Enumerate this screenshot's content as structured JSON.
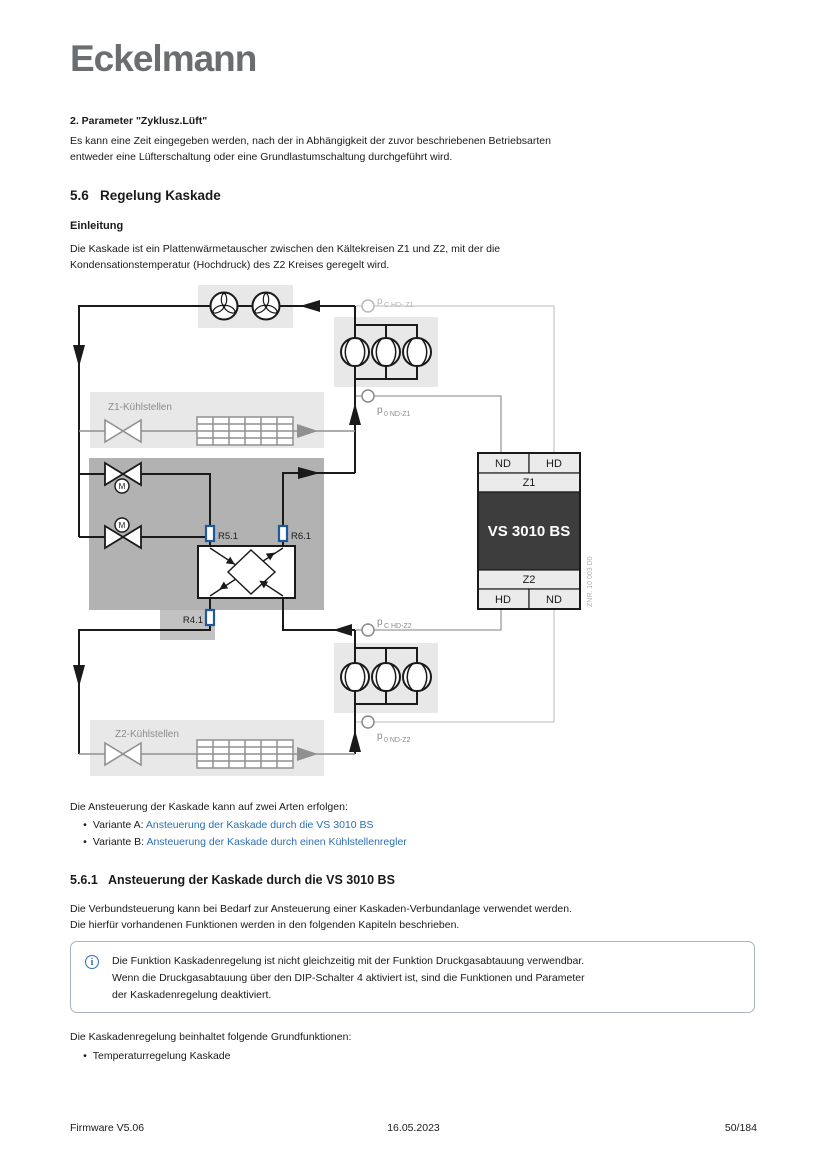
{
  "logo": {
    "text": "Eckelmann",
    "color": "#6b6e70"
  },
  "intro_block": {
    "heading": "2. Parameter \"Zyklusz.Lüft\"",
    "lines": [
      "Es kann eine Zeit eingegeben werden, nach der in Abhängigkeit der zuvor beschriebenen Betriebsarten",
      "entweder eine Lüfterschaltung oder eine Grundlastumschaltung durchgeführt wird."
    ]
  },
  "section_56": {
    "number": "5.6",
    "title": "Regelung Kaskade"
  },
  "einleitung": {
    "heading": "Einleitung",
    "lines": [
      "Die Kaskade ist ein Plattenwärmetauscher zwischen den Kältekreisen Z1 und Z2, mit der die",
      "Kondensationstemperatur (Hochdruck) des Z2 Kreises geregelt wird."
    ]
  },
  "diagram": {
    "z1_kuehlstellen": "Z1-Kühlstellen",
    "z2_kuehlstellen": "Z2-Kühlstellen",
    "r51": "R5.1",
    "r61": "R6.1",
    "r41": "R4.1",
    "motor_letter": "M",
    "controller": {
      "top_left": "ND",
      "top_right": "HD",
      "zone_top": "Z1",
      "name": "VS 3010 BS",
      "zone_bottom": "Z2",
      "bottom_left": "HD",
      "bottom_right": "ND",
      "znr": "ZNR. 10 003 D0"
    },
    "pressure_labels": {
      "symbol": "p",
      "hd_z1": "C HD- Z1",
      "nd_z1": "0 ND-Z1",
      "hd_z2": "C HD-Z2",
      "nd_z2": "0 ND-Z2"
    },
    "colors": {
      "light_box": "#e8e8e8",
      "dark_box": "#b2b2b2",
      "controller_dark": "#3d3d3d",
      "sensor_blue": "#1b5a9e",
      "gray_symbol": "#909090",
      "pipe_black": "#1a1a1a"
    }
  },
  "variants": {
    "intro": "Die Ansteuerung der Kaskade kann auf zwei Arten erfolgen:",
    "items": [
      {
        "bullet": "•",
        "prefix": "Variante A: ",
        "link": "Ansteuerung der Kaskade durch die VS 3010 BS"
      },
      {
        "bullet": "•",
        "prefix": "Variante B: ",
        "link": "Ansteuerung der Kaskade durch einen Kühlstellenregler"
      }
    ],
    "link_color": "#2b6fb5"
  },
  "section_561": {
    "number": "5.6.1",
    "title": "Ansteuerung der Kaskade durch die VS 3010 BS",
    "lines": [
      "Die Verbundsteuerung kann bei Bedarf zur Ansteuerung einer Kaskaden-Verbundanlage verwendet werden.",
      "Die hierfür vorhandenen Funktionen werden in den folgenden Kapiteln beschrieben."
    ]
  },
  "info_box": {
    "icon": "i",
    "lines": [
      "Die Funktion Kaskadenregelung ist nicht gleichzeitig mit der Funktion Druckgasabtauung verwendbar.",
      "Wenn die Druckgasabtauung über den DIP-Schalter 4 aktiviert ist, sind die Funktionen und Parameter",
      "der Kaskadenregelung deaktiviert."
    ]
  },
  "grundfunktionen": {
    "intro": "Die Kaskadenregelung beinhaltet folgende Grundfunktionen:",
    "items": [
      {
        "bullet": "•",
        "text": "Temperaturregelung Kaskade"
      }
    ]
  },
  "footer": {
    "left": "Firmware V5.06",
    "center": "16.05.2023",
    "right": "50/184"
  }
}
